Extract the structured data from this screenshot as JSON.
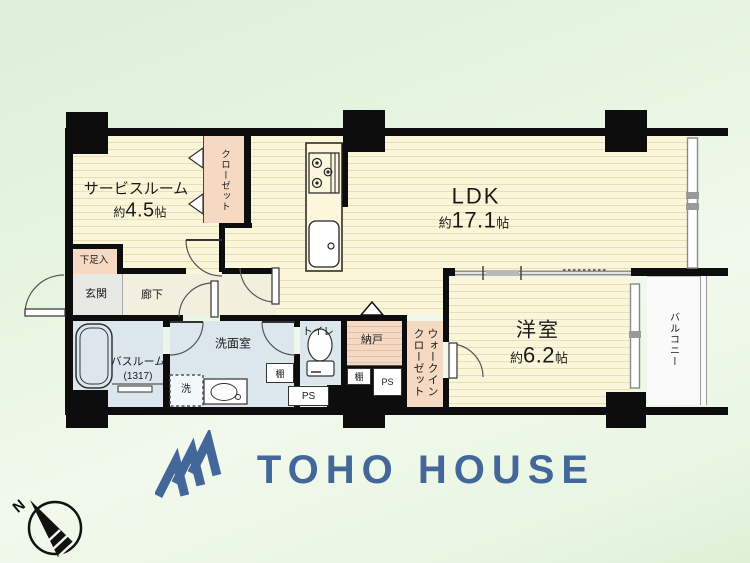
{
  "floorplan": {
    "rooms": {
      "service_room": {
        "name": "サービスルーム",
        "size_prefix": "約",
        "size_value": "4.5",
        "size_unit": "帖"
      },
      "ldk": {
        "name": "LDK",
        "size_prefix": "約",
        "size_value": "17.1",
        "size_unit": "帖"
      },
      "western_room": {
        "name": "洋室",
        "size_prefix": "約",
        "size_value": "6.2",
        "size_unit": "帖"
      },
      "closet": {
        "name": "クローゼット"
      },
      "walk_in_closet": {
        "name": "ウォークインクローゼット"
      },
      "balcony": {
        "name": "バルコニー"
      },
      "entrance": {
        "name": "玄関"
      },
      "hallway": {
        "name": "廊下"
      },
      "shoe_cabinet": {
        "name": "下足入"
      },
      "bathroom": {
        "name": "バスルーム",
        "size": "(1317)"
      },
      "washroom": {
        "name": "洗面室"
      },
      "washer_space": {
        "name": "洗"
      },
      "toilet": {
        "name": "トイレ"
      },
      "storage_room": {
        "name": "納戸"
      },
      "shelf_washroom": {
        "name": "棚"
      },
      "shelf_storage": {
        "name": "棚"
      },
      "pipe_space_1": {
        "name": "PS"
      },
      "pipe_space_2": {
        "name": "PS"
      }
    },
    "compass": {
      "label": "N"
    }
  },
  "branding": {
    "logo_text": "TOHO HOUSE"
  },
  "colors": {
    "brand_blue": "#44679a",
    "wall_black": "#0d0d0d",
    "floor_cream": "#fbf6da",
    "closet_pink": "#f6d9c3",
    "wet_area_blue": "#dce7ed",
    "background_green": "#e4f3df"
  }
}
